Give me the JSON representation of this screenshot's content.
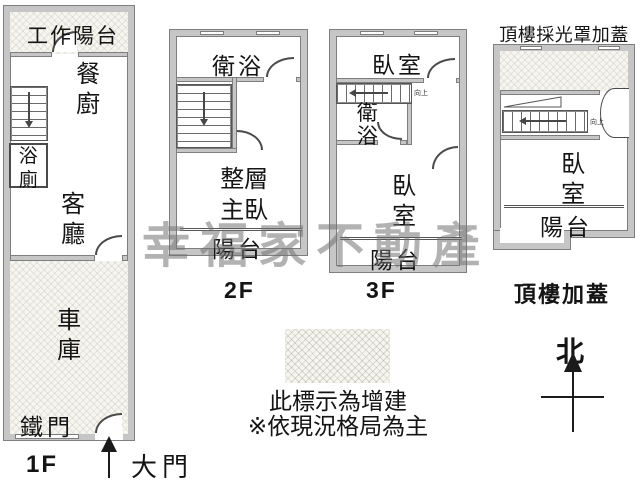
{
  "watermark": "幸福家不動產",
  "floor1": {
    "name": "1F",
    "work_balcony": "工作陽台",
    "dining_kitchen": "餐廚",
    "bathroom": "浴廁",
    "living_room": "客廳",
    "garage": "車庫",
    "iron_door": "鐵門",
    "main_door": "大門"
  },
  "floor2": {
    "name": "2F",
    "bathroom": "衛浴",
    "master_bedroom": "整層主臥",
    "balcony": "陽台"
  },
  "floor3": {
    "name": "3F",
    "bedroom_upper": "臥室",
    "bathroom": "衛浴",
    "bedroom": "臥室",
    "balcony": "陽台",
    "stair_note": "向上"
  },
  "roof": {
    "name": "頂樓加蓋",
    "title": "頂樓採光罩加蓋",
    "bedroom": "臥室",
    "balcony": "陽台",
    "stair_note": "向上"
  },
  "legend": {
    "line1": "此標示為增建",
    "line2": "※依現況格局為主"
  },
  "compass": {
    "north": "北"
  },
  "colors": {
    "wall_fill": "#c6c6c6",
    "wall_edge": "#7e7e7e",
    "line": "#4a4a4a",
    "hatch_bg": "#f6f5ef",
    "watermark_gray": "#737373"
  }
}
